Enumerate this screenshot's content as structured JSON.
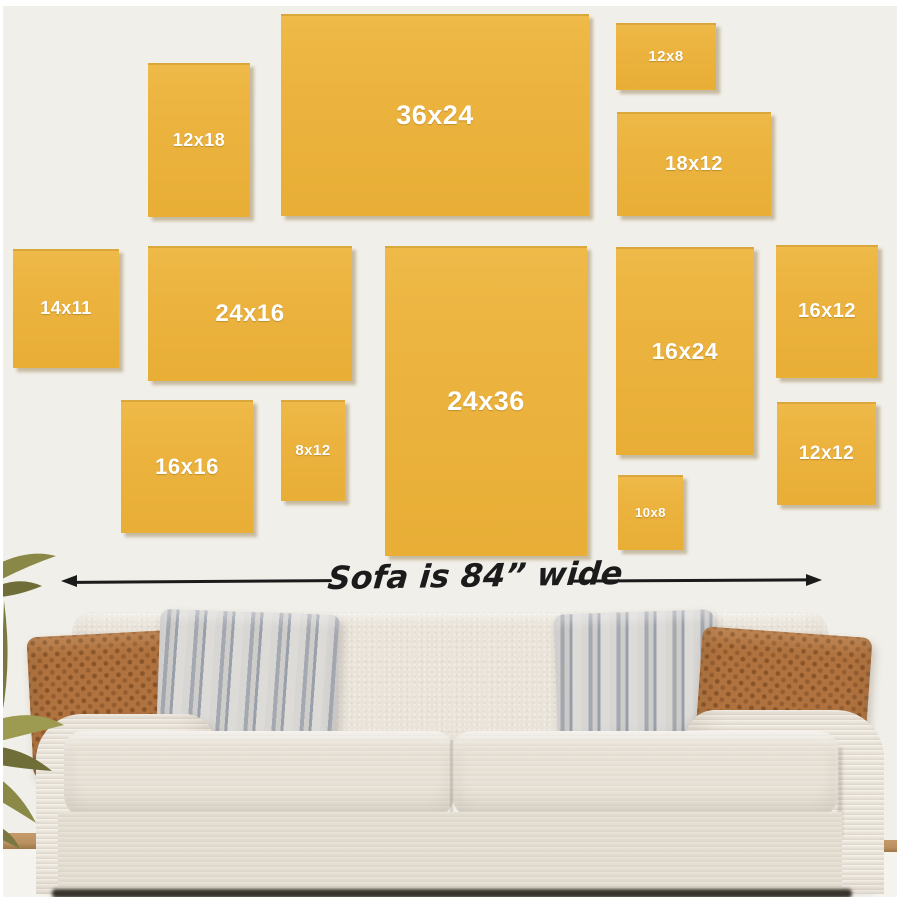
{
  "scene": {
    "wall_color": "#f1efe9",
    "frame_color": "#ecb440",
    "frame_shadow_color": "rgba(125,98,40,0.38)",
    "frame_label_color": "#ffffff",
    "frames": [
      {
        "label": "12x18",
        "x": 148,
        "y": 63,
        "w": 102,
        "h": 154,
        "font": 18
      },
      {
        "label": "36x24",
        "x": 281,
        "y": 14,
        "w": 308,
        "h": 202,
        "font": 27
      },
      {
        "label": "12x8",
        "x": 616,
        "y": 23,
        "w": 100,
        "h": 67,
        "font": 15
      },
      {
        "label": "18x12",
        "x": 617,
        "y": 112,
        "w": 154,
        "h": 104,
        "font": 20
      },
      {
        "label": "14x11",
        "x": 13,
        "y": 249,
        "w": 106,
        "h": 119,
        "font": 18
      },
      {
        "label": "24x16",
        "x": 148,
        "y": 246,
        "w": 204,
        "h": 135,
        "font": 24
      },
      {
        "label": "24x36",
        "x": 385,
        "y": 246,
        "w": 202,
        "h": 310,
        "font": 27
      },
      {
        "label": "16x24",
        "x": 616,
        "y": 247,
        "w": 138,
        "h": 208,
        "font": 23
      },
      {
        "label": "16x12",
        "x": 776,
        "y": 245,
        "w": 102,
        "h": 133,
        "font": 20
      },
      {
        "label": "16x16",
        "x": 121,
        "y": 400,
        "w": 132,
        "h": 133,
        "font": 22
      },
      {
        "label": "8x12",
        "x": 281,
        "y": 400,
        "w": 64,
        "h": 101,
        "font": 15
      },
      {
        "label": "10x8",
        "x": 618,
        "y": 475,
        "w": 65,
        "h": 75,
        "font": 13
      },
      {
        "label": "12x12",
        "x": 777,
        "y": 402,
        "w": 99,
        "h": 103,
        "font": 19
      }
    ],
    "annotation": {
      "text": "Sofa is 84” wide",
      "color": "#1b1b1b"
    },
    "sofa": {
      "body_color": "#e9e3d9",
      "arm_color": "#ece6dc",
      "seat_color": "#eae4da",
      "base_color": "#e6e0d5",
      "pillow_rust_color": "#b0733f",
      "pillow_stripe_light": "#dddbd8",
      "pillow_stripe_dark": "#a4a8b0",
      "shadow_color": "#38332c",
      "floor_wood_color": "#bb9162"
    }
  }
}
